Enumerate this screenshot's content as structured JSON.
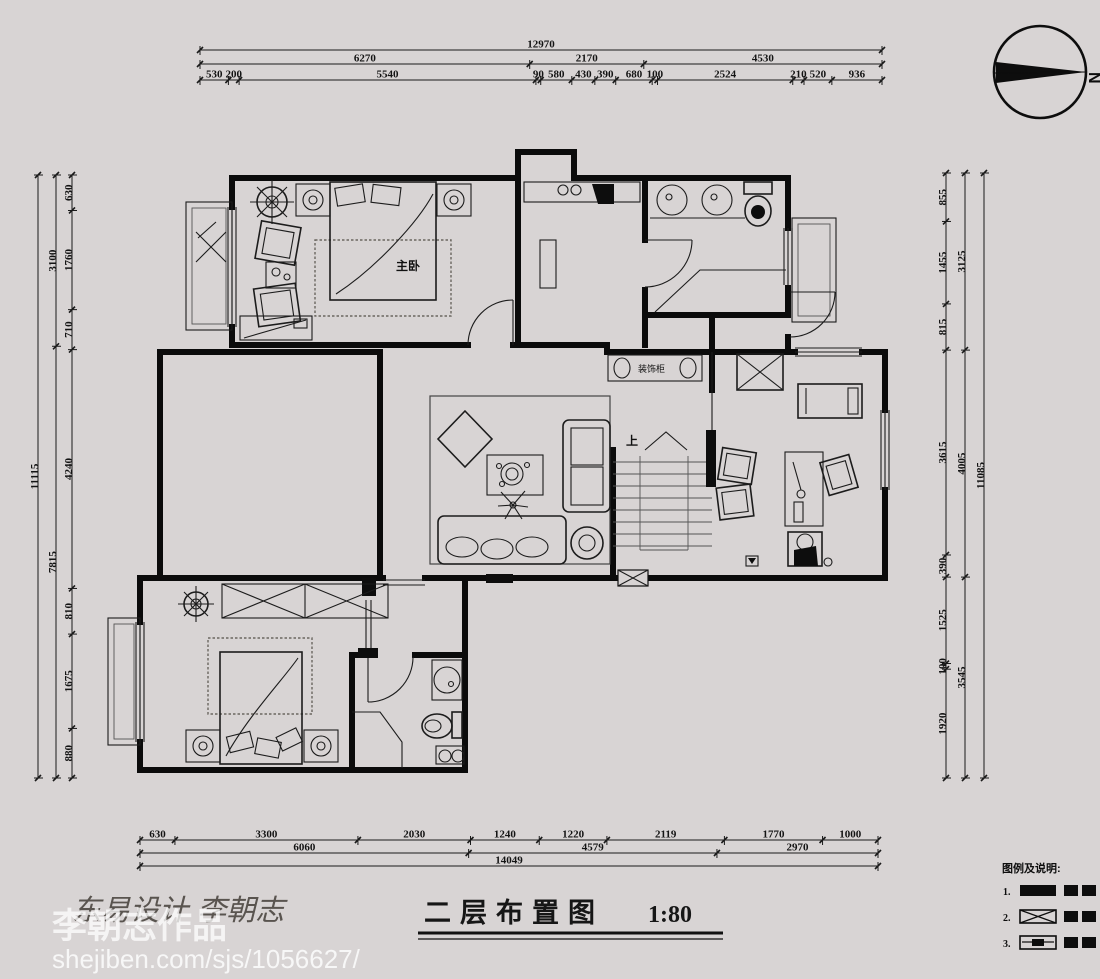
{
  "north": {
    "letter": "N"
  },
  "title": {
    "text": "二层布置图",
    "scale": "1:80"
  },
  "signature": {
    "text": "东易设计 李朝志"
  },
  "watermark": {
    "name": "李朝志作品",
    "url": "shejiben.com/sjs/1056627/"
  },
  "rooms": {
    "master_bedroom": "主卧",
    "decor_cabinet": "装饰柜",
    "stairs_up": "上"
  },
  "legend": {
    "header": "图例及说明:",
    "items": [
      {
        "num": "1.",
        "symbol": "solid-wall-bar"
      },
      {
        "num": "2.",
        "symbol": "x-crossed-box"
      },
      {
        "num": "3.",
        "symbol": "hatched-bar"
      }
    ]
  },
  "dimensions": {
    "top": {
      "total": [
        12970
      ],
      "mid": [
        6270,
        2170,
        4530
      ],
      "detail": [
        530,
        200,
        5540,
        90,
        580,
        430,
        390,
        680,
        100,
        2524,
        210,
        520,
        936
      ]
    },
    "bottom": {
      "detail": [
        630,
        3300,
        2030,
        1240,
        1220,
        2119,
        1770,
        1000
      ],
      "mid": [
        6060,
        4579,
        2970
      ],
      "total": [
        14049
      ]
    },
    "left": {
      "total": [
        11115
      ],
      "mid": [
        3100,
        7815
      ],
      "detail": [
        630,
        1760,
        710,
        4240,
        810,
        1675,
        880
      ]
    },
    "right": {
      "detail": [
        855,
        1455,
        815,
        3615,
        390,
        1525,
        100,
        1920
      ],
      "mid": [
        3125,
        4005,
        3545
      ],
      "total": [
        11085
      ]
    }
  }
}
